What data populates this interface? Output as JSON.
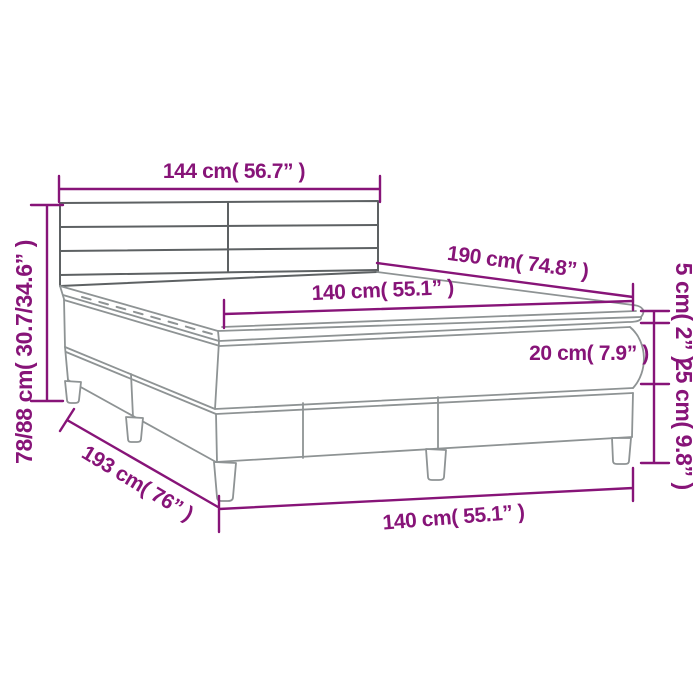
{
  "page": {
    "width": 700,
    "height": 700,
    "background": "#ffffff",
    "accent_color": "#871478",
    "drawing_line_color": "#8e9394",
    "headboard_line_color": "#5d6163"
  },
  "diagram": {
    "subject": "box-spring-bed-dimension-drawing",
    "parts": [
      "headboard",
      "mattress-topper",
      "mattress",
      "box-spring-base",
      "legs"
    ],
    "labels": {
      "headboard_width": "144 cm( 56.7” )",
      "total_height": "78/88 cm( 30.7/34.6” )",
      "mattress_length": "190 cm( 74.8” )",
      "mattress_width": "140 cm( 55.1” )",
      "topper_thickness": "5 cm( 2” )",
      "mattress_thickness": "20 cm( 7.9” )",
      "base_height": "25 cm( 9.8” )",
      "base_width": "140 cm( 55.1” )",
      "base_length": "193 cm( 76” )"
    }
  }
}
